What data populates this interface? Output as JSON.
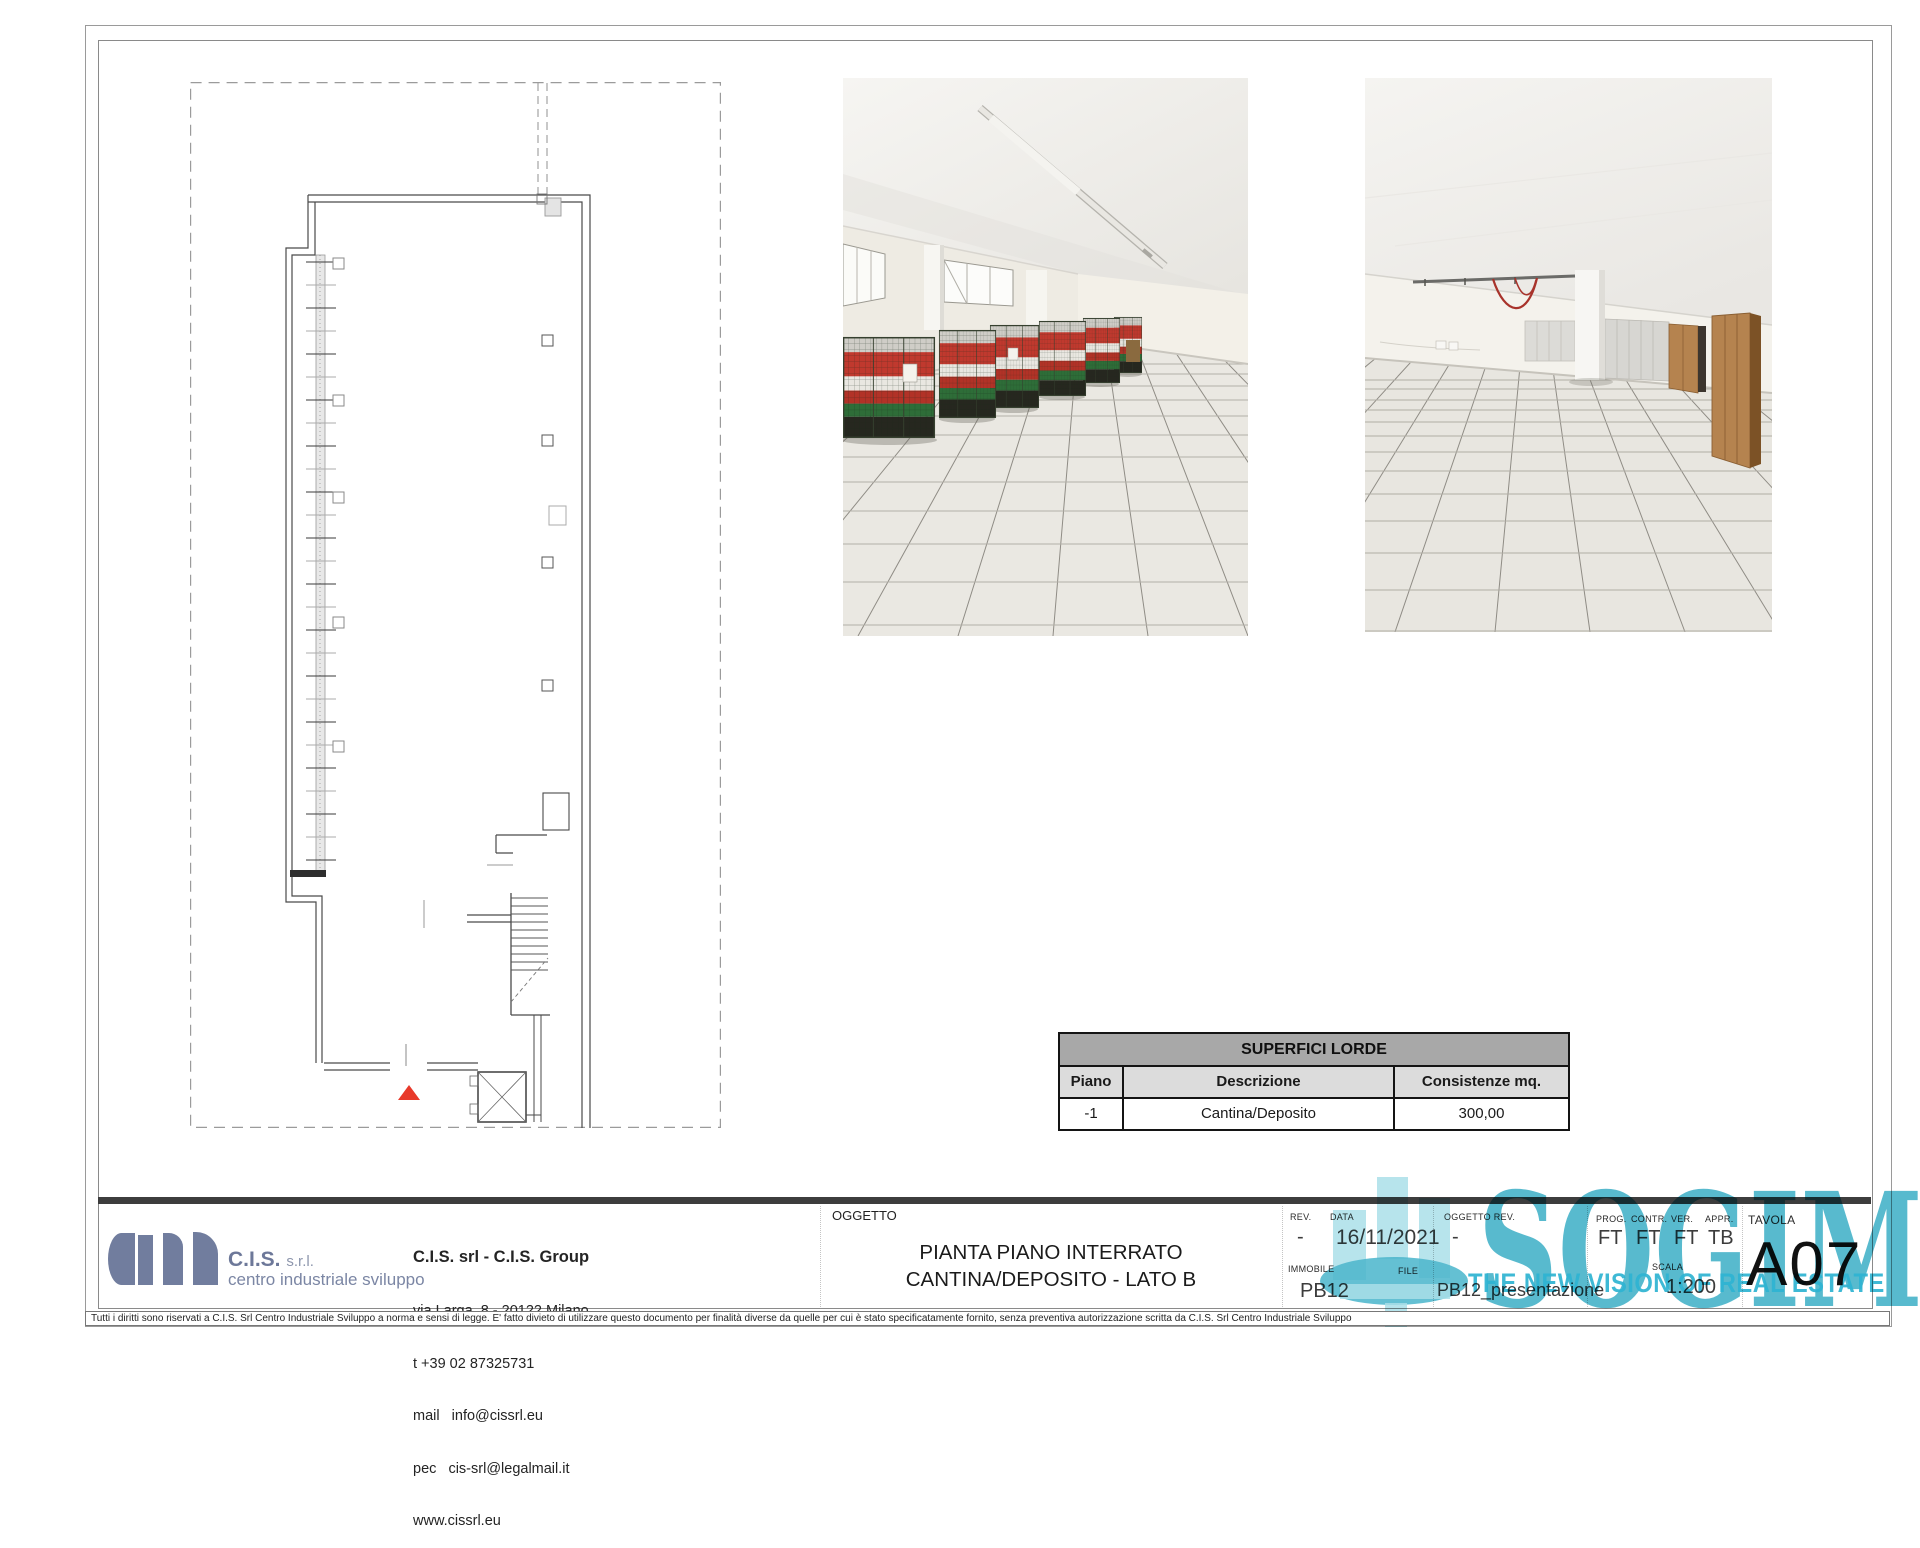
{
  "table": {
    "title": "SUPERFICI LORDE",
    "headers": [
      "Piano",
      "Descrizione",
      "Consistenze mq."
    ],
    "rows": [
      [
        "-1",
        "Cantina/Deposito",
        "300,00"
      ]
    ]
  },
  "title_block": {
    "logo": {
      "name": "C.I.S.",
      "suffix": "s.r.l.",
      "subtitle": "centro industriale sviluppo",
      "color": "#717d9e"
    },
    "company": {
      "lines": [
        "C.I.S. srl - C.I.S. Group",
        "via Larga, 8 - 20122 Milano",
        "t +39 02 87325731",
        "mail   info@cissrl.eu",
        "pec   cis-srl@legalmail.it",
        "www.cissrl.eu"
      ]
    },
    "oggetto_label": "OGGETTO",
    "subject": {
      "line1": "PIANTA PIANO INTERRATO",
      "line2": "CANTINA/DEPOSITO - LATO B"
    },
    "fields": {
      "rev": {
        "label": "REV.",
        "value": "-"
      },
      "data": {
        "label": "DATA",
        "value": "16/11/2021"
      },
      "oggetto_rev": {
        "label": "OGGETTO REV.",
        "value": "-"
      },
      "prog": {
        "label": "PROG.",
        "value": "FT"
      },
      "contr": {
        "label": "CONTR.",
        "value": "FT"
      },
      "ver": {
        "label": "VER.",
        "value": "FT"
      },
      "appr": {
        "label": "APPR.",
        "value": "TB"
      },
      "tavola": {
        "label": "TAVOLA",
        "value": "A07"
      },
      "immobile": {
        "label": "IMMOBILE",
        "value": "PB12"
      },
      "file": {
        "label": "FILE",
        "value": "PB12_presentazione"
      },
      "scala": {
        "label": "SCALA",
        "value": "1:200"
      }
    },
    "disclaimer": "Tutti i diritti sono riservati a C.I.S. Srl Centro Industriale Sviluppo a norma e sensi di legge. E' fatto divieto di utilizzare questo documento per finalità diverse da quelle per cui è stato specificatamente fornito, senza preventiva autorizzazione scritta da C.I.S. Srl Centro Industriale Sviluppo"
  },
  "watermark": {
    "text": "SOGIM",
    "tagline": "THE NEW VISION OF REAL ESTATE",
    "color": "#3cb4cc"
  },
  "plan": {
    "entrance_marker_color": "#e8392a"
  }
}
